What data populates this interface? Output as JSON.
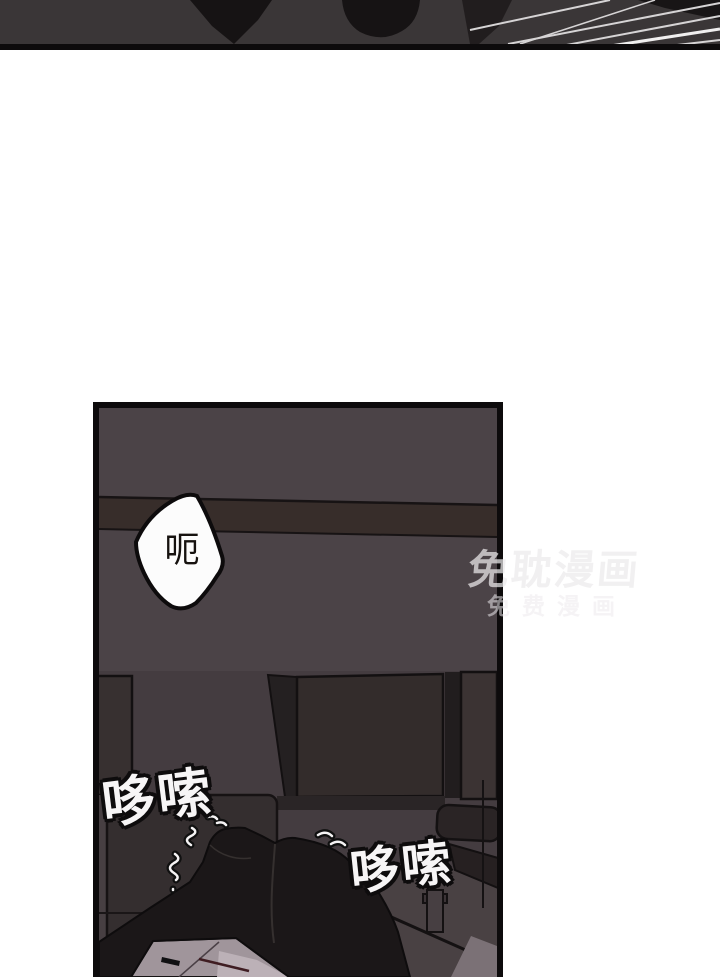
{
  "page": {
    "kind": "comic-page",
    "background": "#ffffff"
  },
  "top_panel": {
    "content": "dark close-up of figure with speed lines",
    "bg_color": "#3a3637",
    "line_color": "#d6d4d5"
  },
  "main_panel": {
    "content": "dark office interior, figure hunched over desk",
    "wall_color": "#4b4347",
    "band_color": "#372d2a",
    "lower_color": "#443c40",
    "figure_color": "#1b1718",
    "border_color": "#0d0b0c"
  },
  "speech_bubble": {
    "text": "呃",
    "fill": "#fcfcfc"
  },
  "sfx": [
    {
      "text": "哆嗦"
    },
    {
      "text": "哆嗦"
    }
  ],
  "watermark": {
    "line1": "免耽漫画",
    "line2": "免费漫画"
  }
}
